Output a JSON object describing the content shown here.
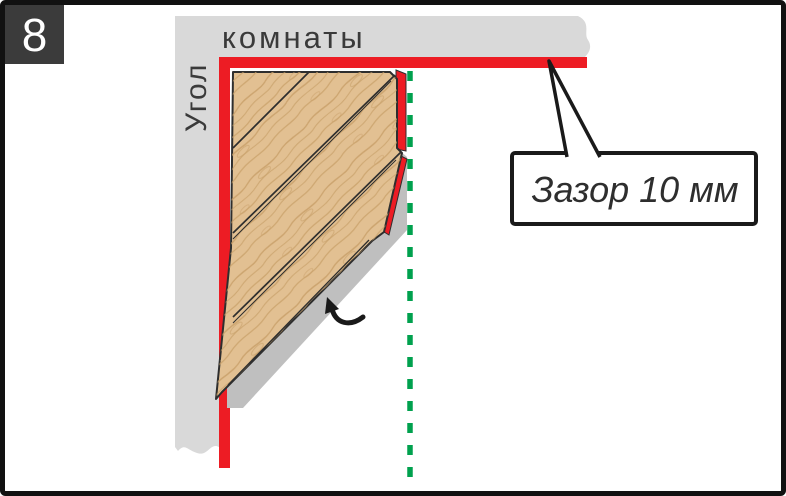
{
  "figure": {
    "step_number": "8",
    "type": "installation-diagram"
  },
  "wall": {
    "vertical_label": "Угол",
    "horizontal_label": "комнаты"
  },
  "callout": {
    "text": "Зазор 10 мм"
  },
  "icons": {
    "direction_arrow": "curved-arrow-up-left-icon",
    "expansion_gap_line": "green-dashed-guide-line"
  },
  "colors": {
    "wall_gray": "#d9d9d9",
    "gap_red": "#ed1c24",
    "guide_green": "#00a14e",
    "wood_base": "#e2c092",
    "wood_grain": "#c79e67",
    "underlay_shadow": "#bfbfbf",
    "outline": "#2e2e2e",
    "badge_bg": "#3b3b3b",
    "frame": "#111111"
  }
}
